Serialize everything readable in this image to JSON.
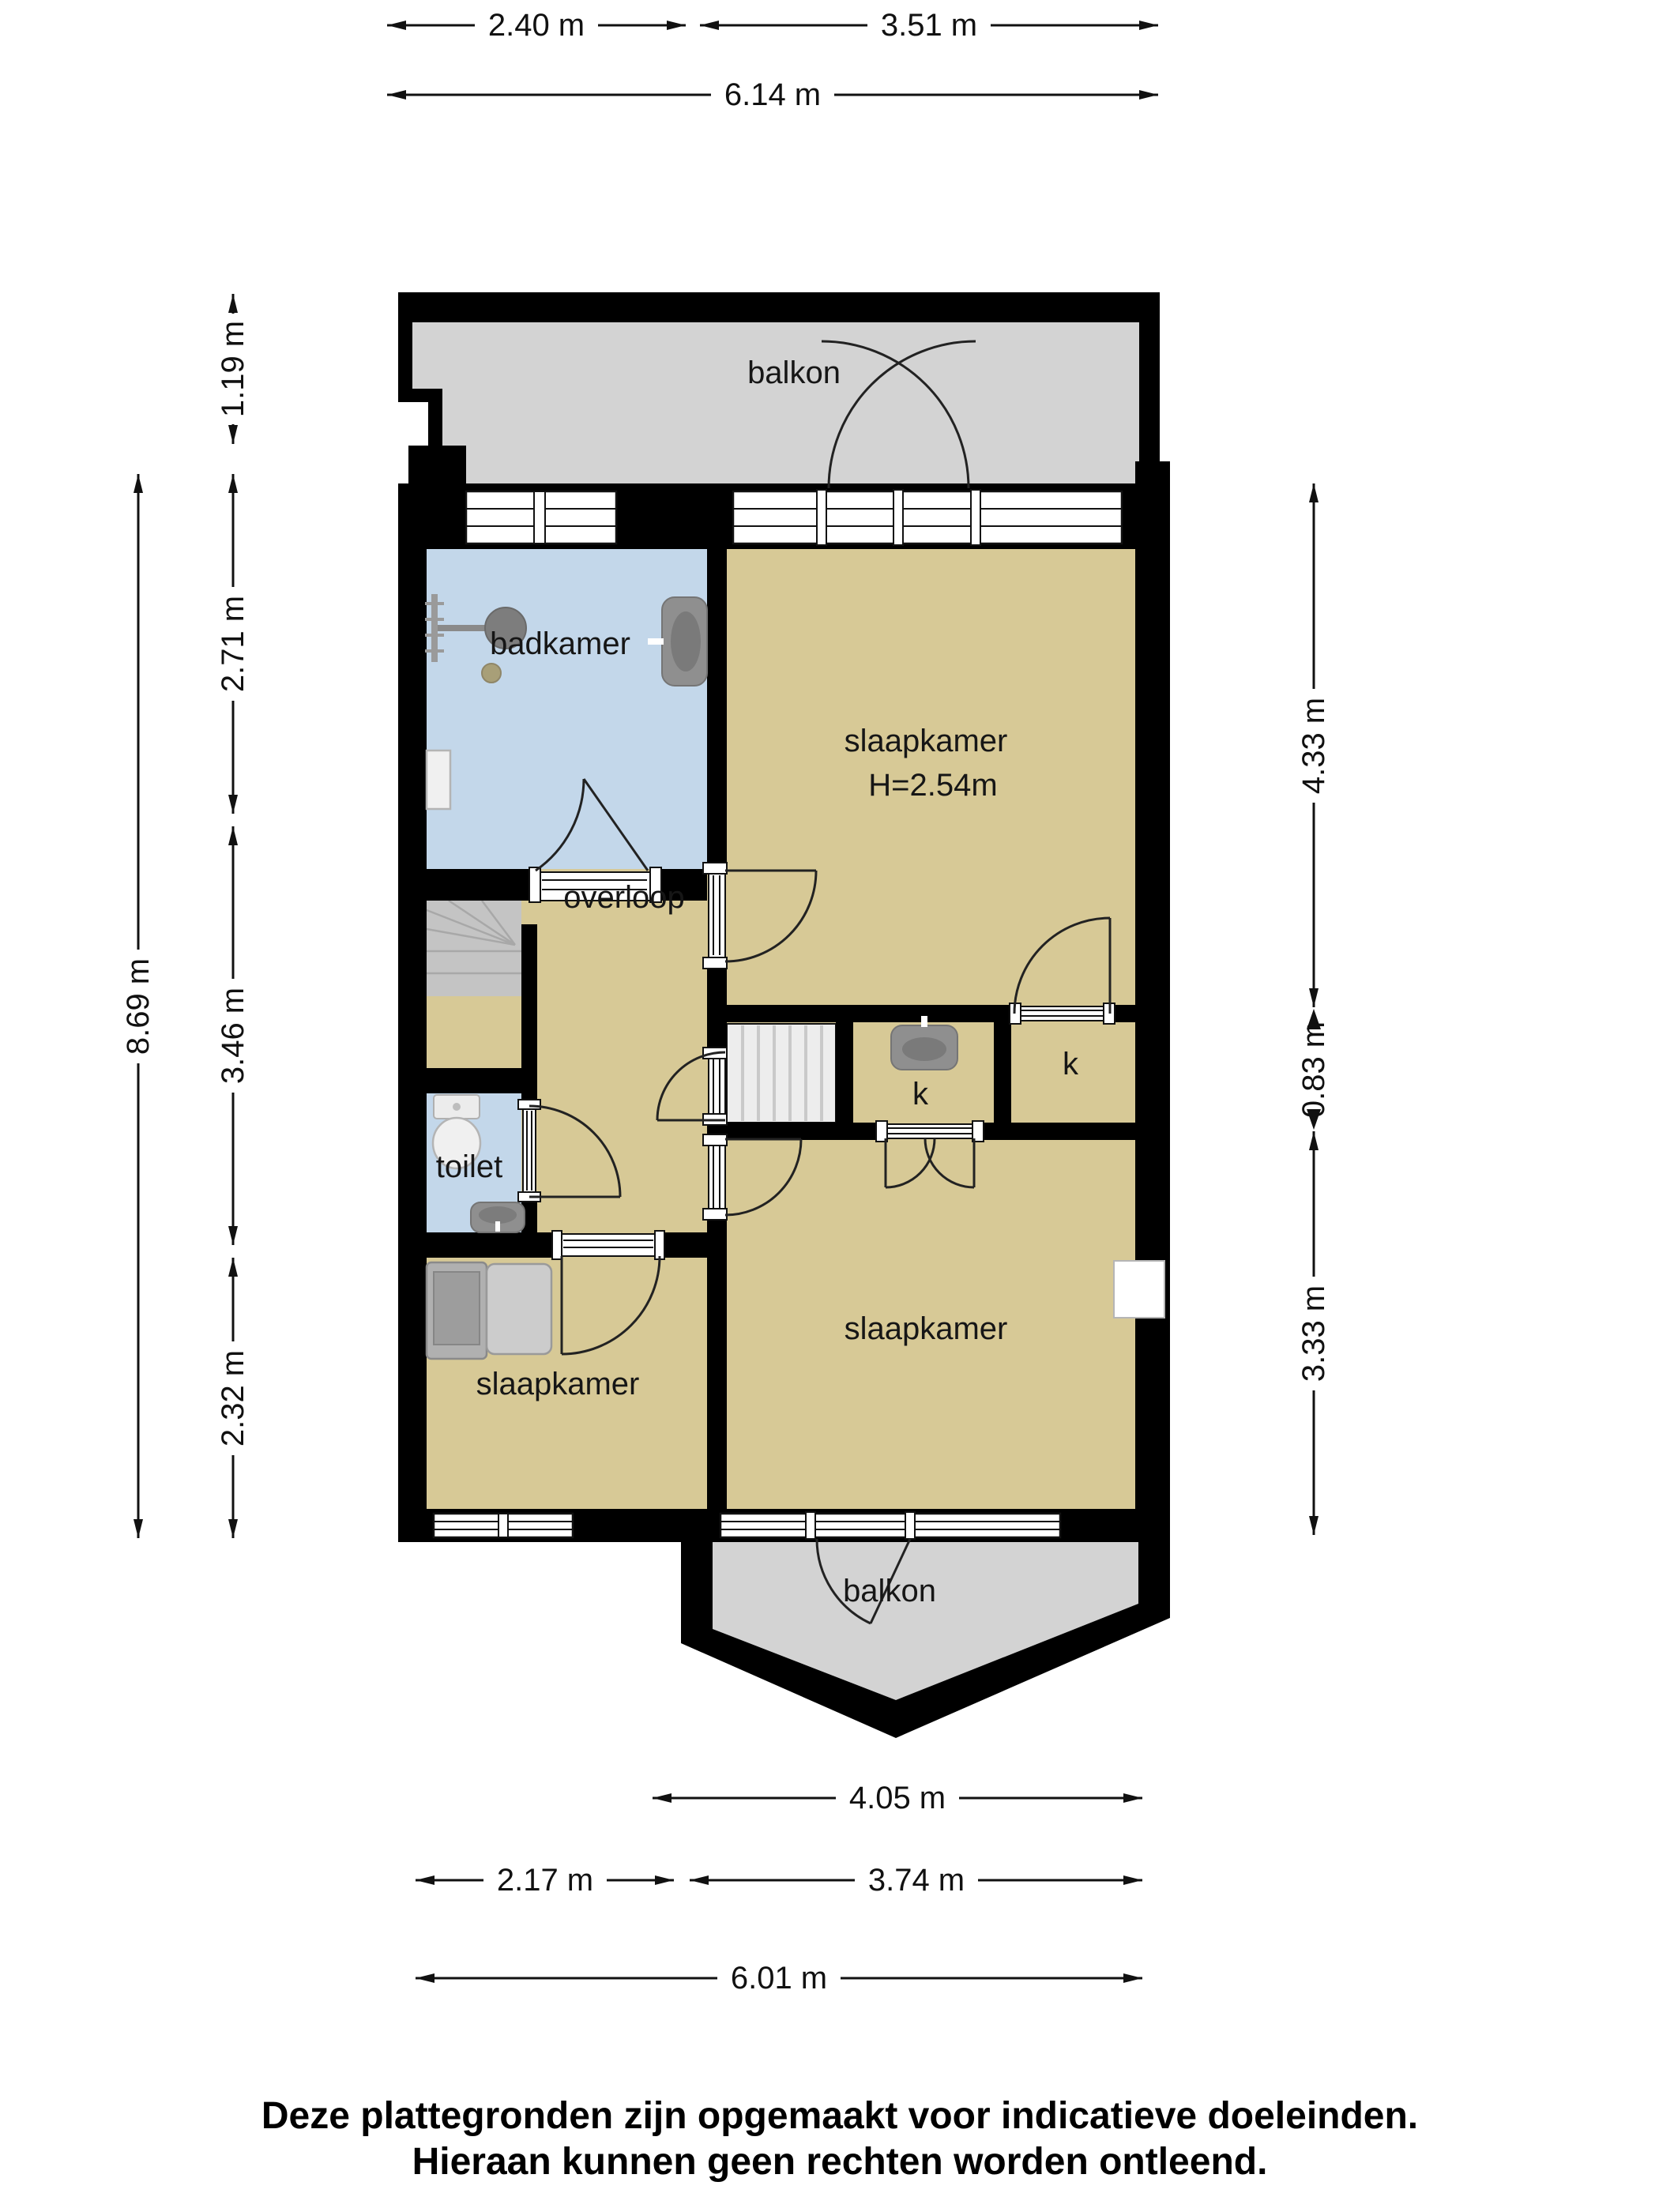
{
  "plan": {
    "rooms": {
      "balkon_top": "balkon",
      "badkamer": "badkamer",
      "slaapkamer_top": "slaapkamer",
      "slaapkamer_top_height": "H=2.54m",
      "overloop": "overloop",
      "toilet": "toilet",
      "closet_left": "k",
      "closet_right": "k",
      "slaapkamer_bottom_left": "slaapkamer",
      "slaapkamer_bottom_right": "slaapkamer",
      "balkon_bottom": "balkon"
    },
    "dimensions": {
      "top_section_left": "2.40 m",
      "top_section_right": "3.51 m",
      "top_total": "6.14 m",
      "left_balcony_depth": "1.19 m",
      "left_upper": "2.71 m",
      "left_middle": "3.46 m",
      "left_lower": "2.32 m",
      "left_total": "8.69 m",
      "right_upper": "4.33 m",
      "right_middle": "0.83 m",
      "right_lower": "3.33 m",
      "bottom_room_width": "4.05 m",
      "bottom_section_left": "2.17 m",
      "bottom_section_right": "3.74 m",
      "bottom_total": "6.01 m"
    },
    "footer": {
      "disclaimer_line1": "Deze plattegronden zijn opgemaakt voor indicatieve doeleinden.",
      "disclaimer_line2": "Hieraan kunnen geen rechten worden ontleend."
    },
    "colors": {
      "wall": "#000000",
      "floor_room": "#d7c996",
      "floor_wet": "#c3d7ea",
      "balcony": "#d3d3d3",
      "stairs": "#c4c4c4",
      "fixture_gray": "#8f8f8f"
    }
  }
}
